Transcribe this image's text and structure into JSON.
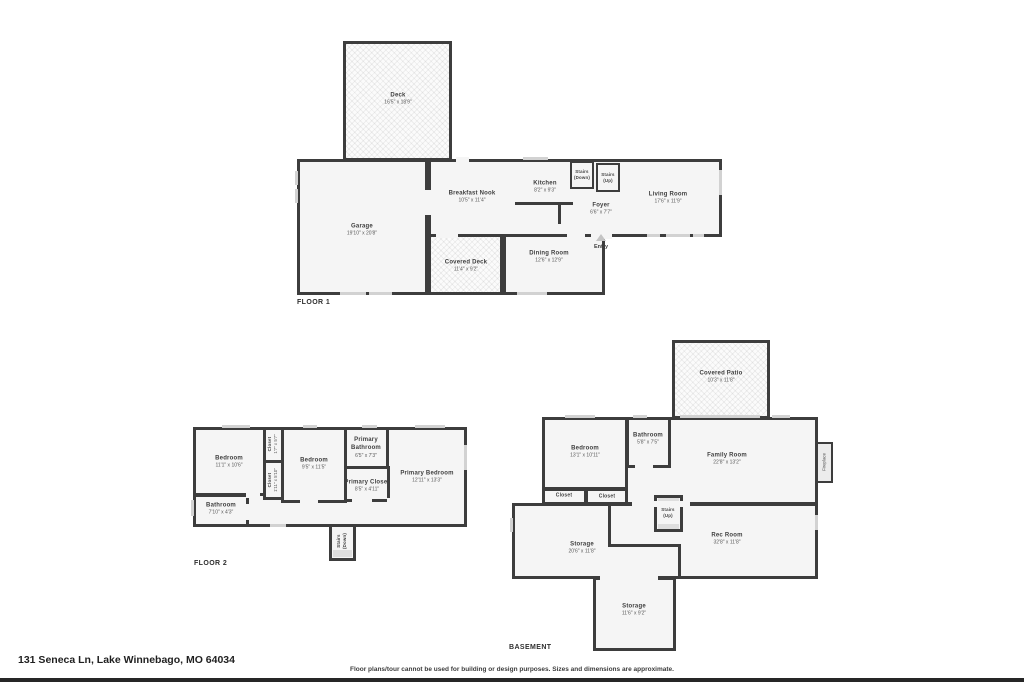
{
  "page": {
    "address": "131 Seneca Ln, Lake Winnebago, MO 64034",
    "disclaimer": "Floor plans/tour cannot be used for building or design purposes. Sizes and dimensions are approximate."
  },
  "colors": {
    "wall": "#3d3d3d",
    "room_fill": "#f5f5f5",
    "window": "#d2d2d2",
    "background": "#ffffff",
    "bottom_bar": "#262626"
  },
  "floor1": {
    "label": "FLOOR 1",
    "rooms": {
      "deck": {
        "name": "Deck",
        "dims": "16'5\" x 18'9\""
      },
      "garage": {
        "name": "Garage",
        "dims": "19'10\" x 20'8\""
      },
      "breakfast_nook": {
        "name": "Breakfast Nook",
        "dims": "10'5\" x 11'4\""
      },
      "kitchen": {
        "name": "Kitchen",
        "dims": "8'2\" x 9'3\""
      },
      "stairs_down": {
        "name": "Stairs",
        "sub": "(Down)"
      },
      "stairs_up": {
        "name": "Stairs",
        "sub": "(Up)"
      },
      "foyer": {
        "name": "Foyer",
        "dims": "6'6\" x 7'7\""
      },
      "living_room": {
        "name": "Living Room",
        "dims": "17'6\" x 11'9\""
      },
      "covered_deck": {
        "name": "Covered Deck",
        "dims": "11'4\" x 9'2\""
      },
      "dining_room": {
        "name": "Dining Room",
        "dims": "12'6\" x 12'9\""
      },
      "entry": {
        "name": "Entry"
      }
    }
  },
  "floor2": {
    "label": "FLOOR 2",
    "rooms": {
      "bedroom_left": {
        "name": "Bedroom",
        "dims": "11'1\" x 10'6\""
      },
      "closet_top": {
        "name": "Closet",
        "dims": "1'7\" x 5'7\""
      },
      "closet_mid": {
        "name": "Closet",
        "dims": "1'11\" x 5'10\""
      },
      "bedroom_mid": {
        "name": "Bedroom",
        "dims": "9'5\" x 11'5\""
      },
      "primary_bathroom": {
        "name": "Primary Bathroom",
        "dims": "6'5\" x 7'3\""
      },
      "primary_closet": {
        "name": "Primary Closet",
        "dims": "8'5\" x 4'11\""
      },
      "primary_bedroom": {
        "name": "Primary Bedroom",
        "dims": "12'11\" x 13'3\""
      },
      "bathroom": {
        "name": "Bathroom",
        "dims": "7'10\" x 4'3\""
      },
      "stairs_down": {
        "name": "Stairs",
        "sub": "(Down)"
      }
    }
  },
  "basement": {
    "label": "BASEMENT",
    "rooms": {
      "covered_patio": {
        "name": "Covered Patio",
        "dims": "10'3\" x 11'8\""
      },
      "bedroom": {
        "name": "Bedroom",
        "dims": "13'1\" x 10'11\""
      },
      "bathroom": {
        "name": "Bathroom",
        "dims": "5'8\" x 7'5\""
      },
      "family_room": {
        "name": "Family Room",
        "dims": "22'8\" x 13'2\""
      },
      "fireplace": {
        "name": "Fireplace"
      },
      "closet_left": {
        "name": "Closet"
      },
      "closet_right": {
        "name": "Closet"
      },
      "stairs_up": {
        "name": "Stairs",
        "sub": "(Up)"
      },
      "storage": {
        "name": "Storage",
        "dims": "20'6\" x 11'8\""
      },
      "rec_room": {
        "name": "Rec Room",
        "dims": "32'8\" x 11'8\""
      },
      "storage_lower": {
        "name": "Storage",
        "dims": "11'6\" x 9'2\""
      }
    }
  }
}
